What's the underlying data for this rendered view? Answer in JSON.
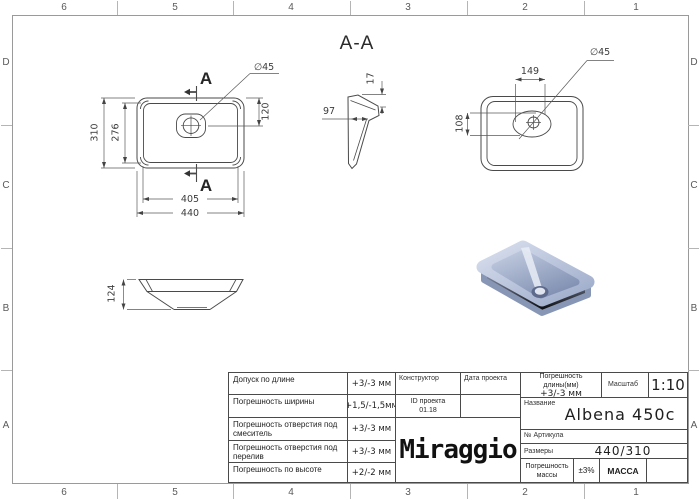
{
  "sheet": {
    "columns": [
      "6",
      "5",
      "4",
      "3",
      "2",
      "1"
    ],
    "rows": [
      "D",
      "C",
      "B",
      "A"
    ]
  },
  "drawing": {
    "section_title": "A-A",
    "section_marker": "A",
    "bottom_view": {
      "outer_width": "440",
      "inner_width": "405",
      "outer_height": "310",
      "inner_height": "276",
      "drain_offset": "120",
      "drain_diameter": "∅45"
    },
    "section_view": {
      "rim_thickness": "17",
      "wall_depth": "97"
    },
    "top_view": {
      "drain_offset_x": "149",
      "drain_offset_y": "108",
      "drain_diameter": "∅45"
    },
    "side_view": {
      "height": "124"
    }
  },
  "title_block": {
    "tolerances": [
      {
        "label": "Допуск по длине",
        "value": "+3/-3 мм"
      },
      {
        "label": "Погрешность ширины",
        "value": "+1,5/-1,5мм"
      },
      {
        "label": "Погрешность отверстия под смеситель",
        "value": "+3/-3 мм"
      },
      {
        "label": "Погрешность отверстия под перелив",
        "value": "+3/-3 мм"
      },
      {
        "label": "Погрешность по высоте",
        "value": "+2/-2 мм"
      }
    ],
    "designer_label": "Конструктор",
    "project_date_label": "Дата проекта",
    "project_id_label": "ID проекта",
    "project_id_value": "01.18",
    "logo": "Miraggio",
    "length_tolerance_label": "Погрешность длины(мм)",
    "length_tolerance_value": "+3/-3 мм",
    "scale_label": "Масштаб",
    "scale_value": "1:10",
    "name_label": "Название",
    "name_value": "Albena 450c",
    "article_label": "№ Артикула",
    "dimensions_label": "Размеры",
    "dimensions_value": "440/310",
    "mass_tolerance_label": "Погрешность массы",
    "mass_tolerance_value": "±3%",
    "mass_label": "МАССА"
  },
  "colors": {
    "line": "#4a4a4a",
    "frame": "#9a9a9a",
    "render_top": "#b9c4db",
    "render_side": "#8494b5",
    "render_highlight": "#e9edf6",
    "render_drain": "#5d6a8c"
  }
}
